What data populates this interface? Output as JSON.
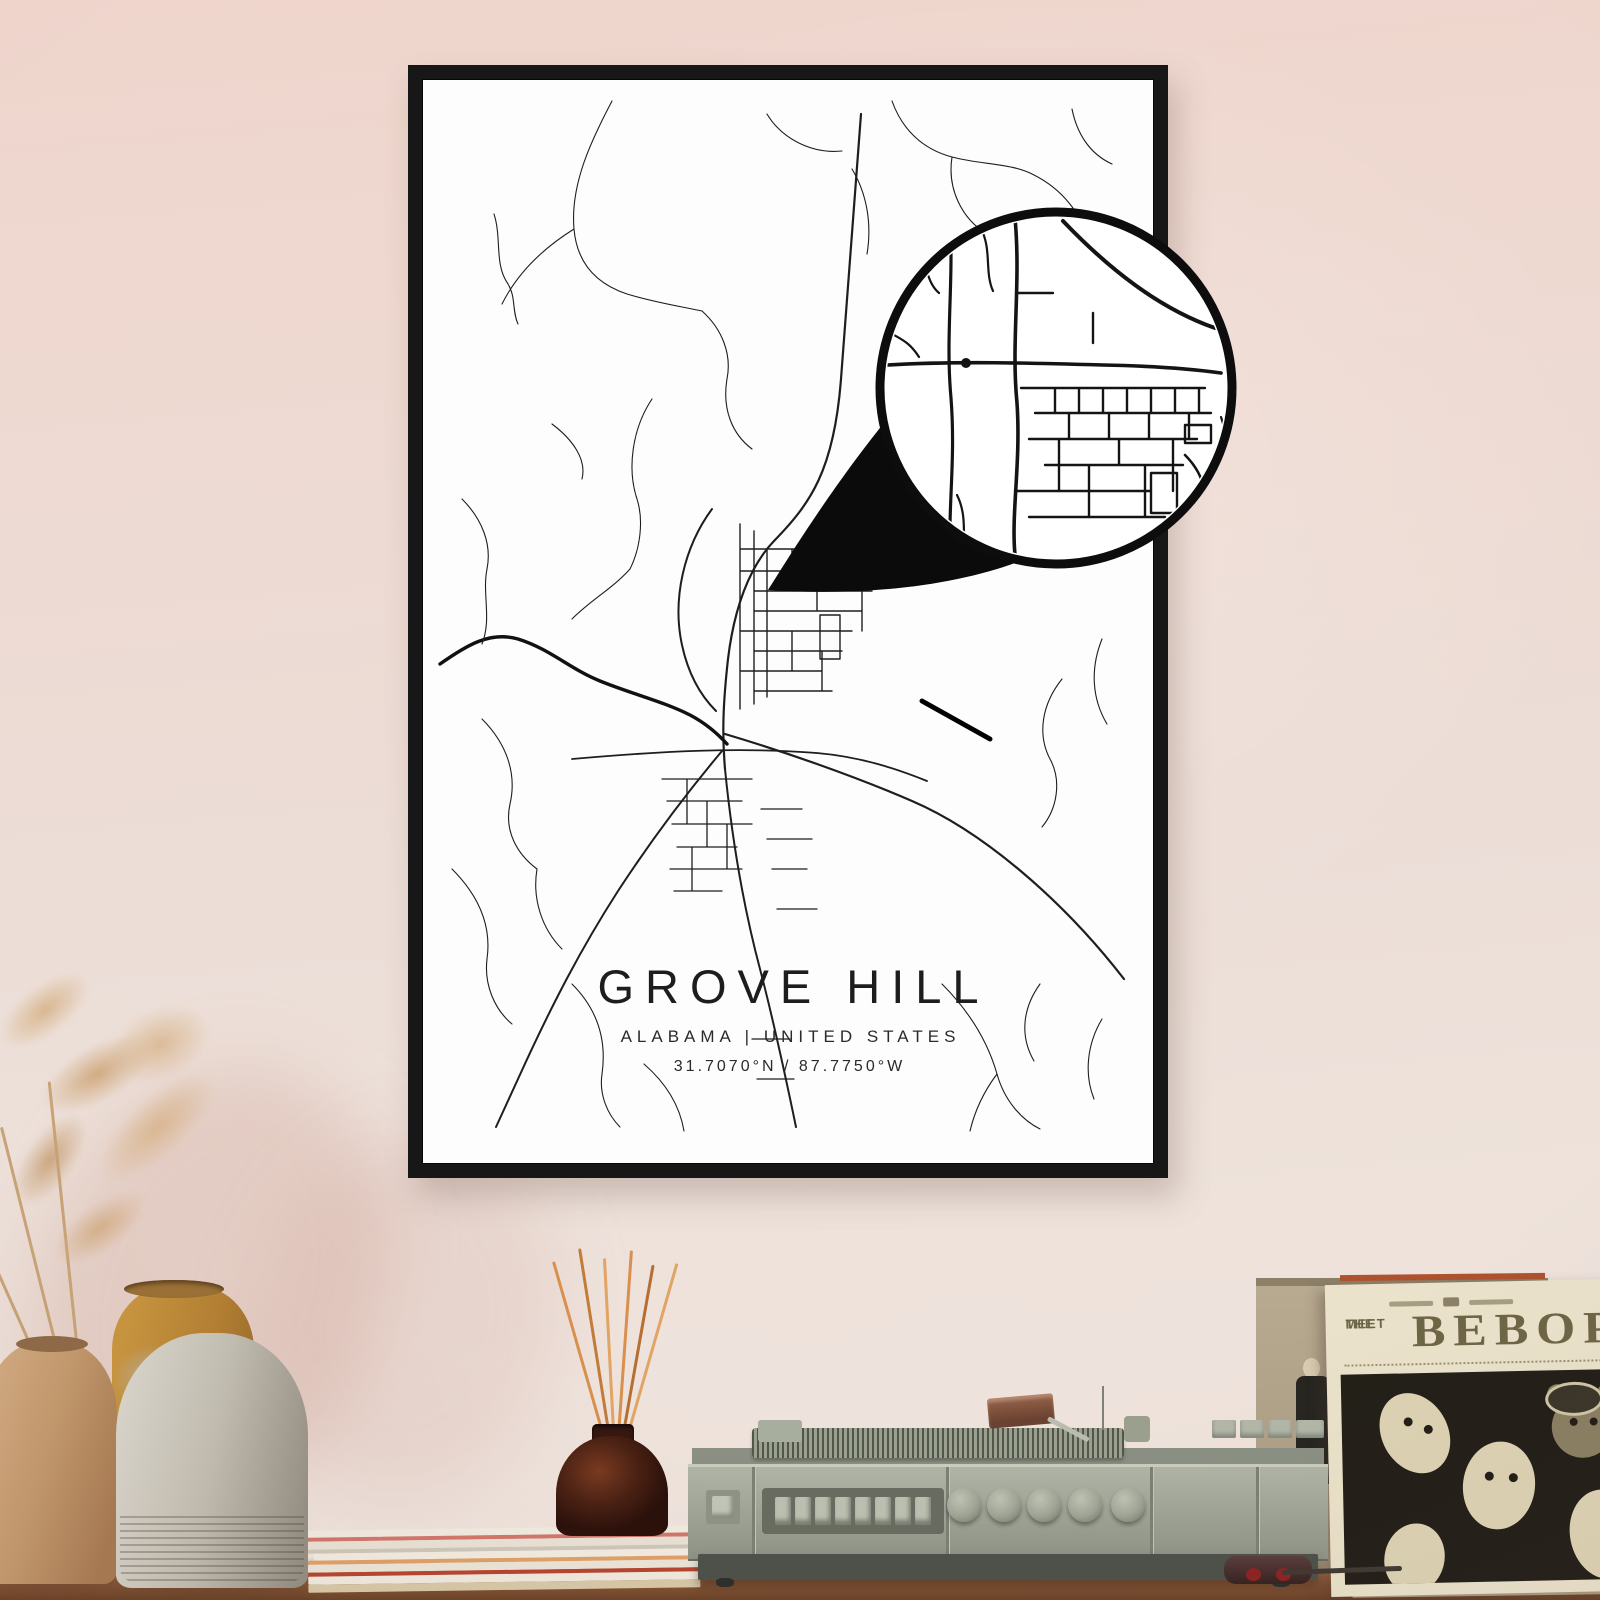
{
  "poster": {
    "title": "GROVE HILL",
    "subtitle": "ALABAMA | UNITED STATES",
    "coordinates": "31.7070°N / 87.7750°W"
  },
  "album": {
    "header_line1": "MEET",
    "header_line2": "THE",
    "title": "BEBOP"
  },
  "colors": {
    "wall_top": "#efd5cc",
    "wall_bottom": "#f0e5de",
    "frame": "#171717",
    "paper": "#fdfdfd",
    "road_ink": "#1e1e1e",
    "magnifier_ink": "#0d0d0d",
    "table_wood": "#a5714b",
    "player_body": "#a9aea1",
    "album_background": "#eae2ca",
    "album_ink": "#6e6446",
    "vase_tan": "#c9a27e",
    "vase_ochre": "#c08a3c",
    "vase_gray": "#c5c0b6",
    "bottle_brown": "#4a2315",
    "reed_orange": "#d98f4e"
  }
}
